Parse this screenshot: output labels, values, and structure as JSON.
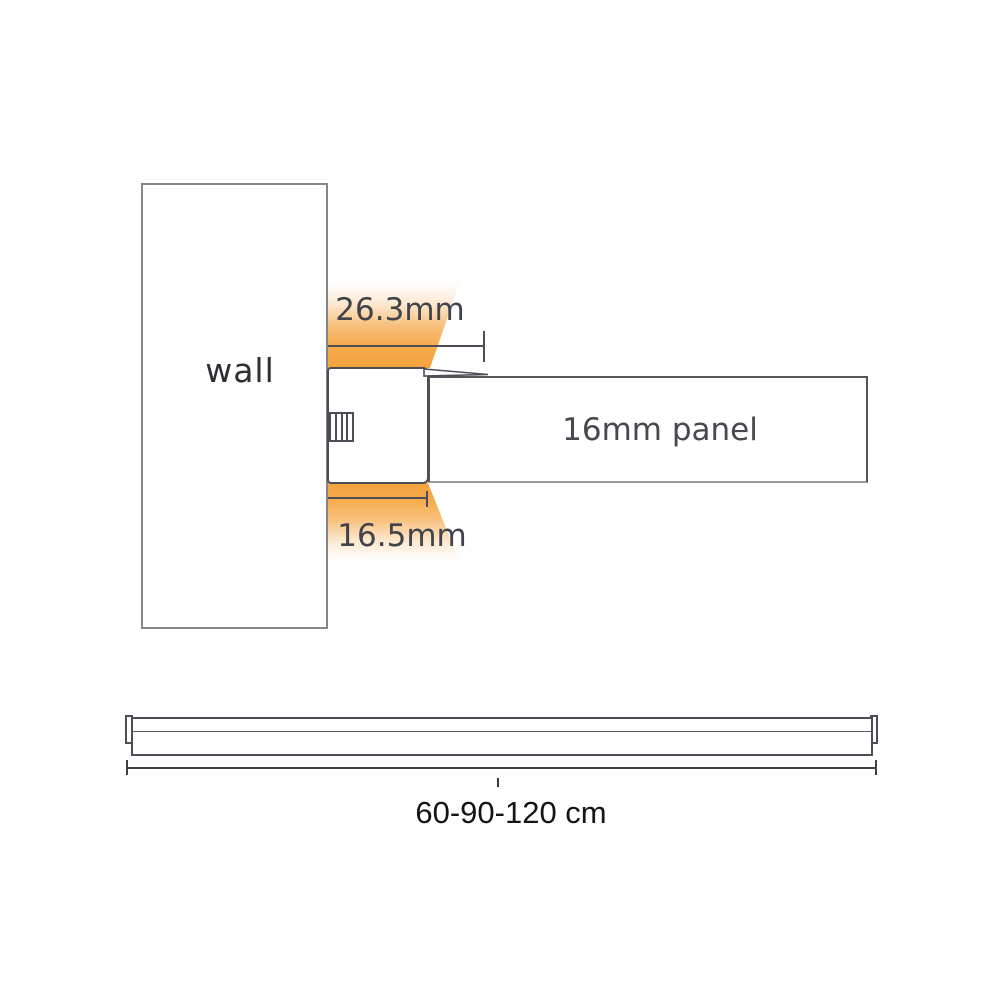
{
  "diagram": {
    "type": "led-cabinet-light-mounting-diagram",
    "cross_section": {
      "wall_label": "wall",
      "panel_label": "16mm panel",
      "top_dimension": "26.3mm",
      "bottom_dimension": "16.5mm"
    },
    "front_view": {
      "length_label": "60-90-120 cm"
    },
    "colors": {
      "glow_orange": "#f5a845",
      "outline_dark": "#4d4d55",
      "wall_border_gray": "#85858c",
      "panel_bottom_gray": "#9a9aa0",
      "label_gray": "#43434b",
      "length_label_black": "#141414",
      "background": "#ffffff"
    }
  }
}
